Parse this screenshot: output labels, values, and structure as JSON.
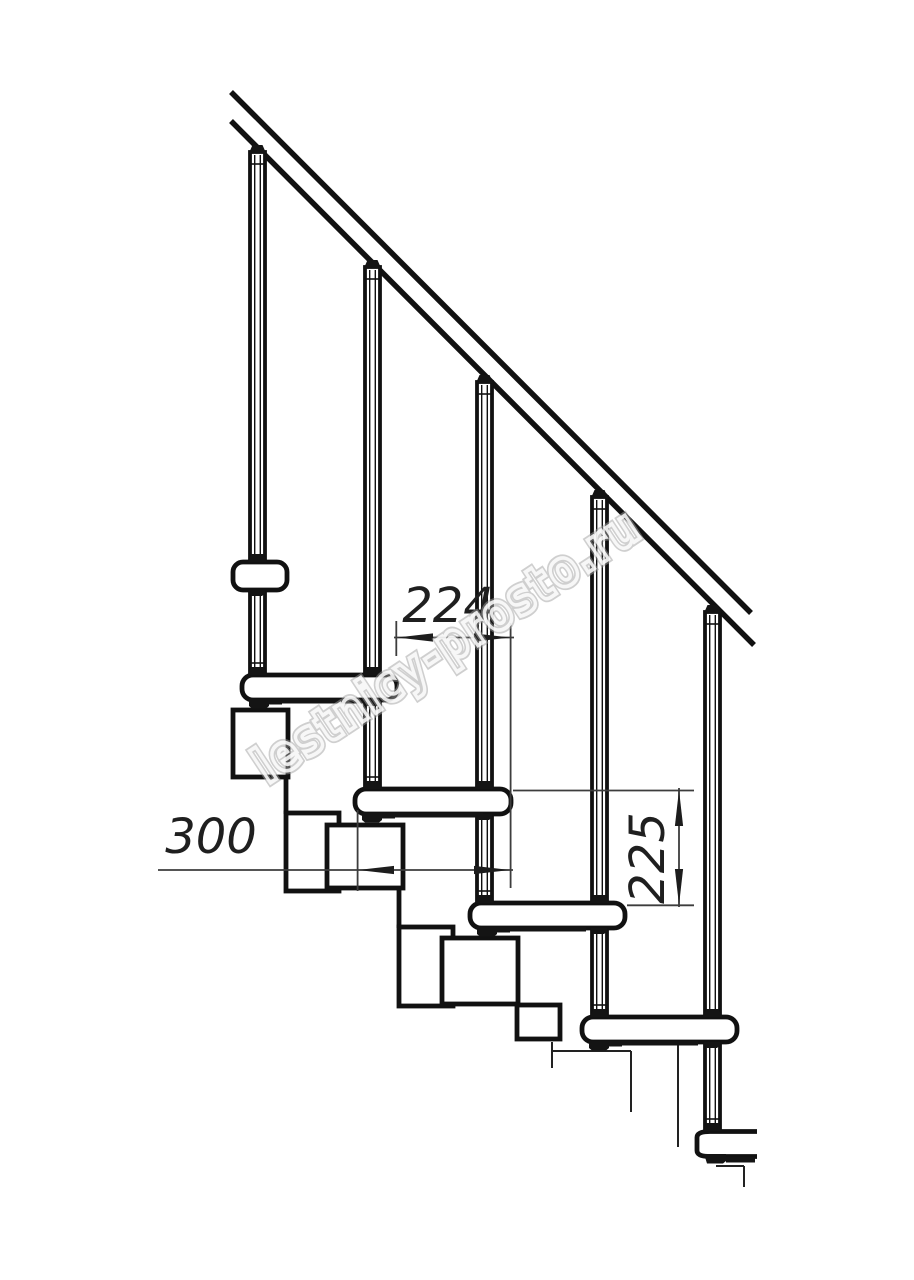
{
  "drawing": {
    "subject": "modular-staircase-side-elevation",
    "colors": {
      "line": "#111111",
      "dimension_line": "#3d3d3d",
      "dimension_text": "#1f1f1f",
      "watermark": "#a0a0a0",
      "background": "#ffffff"
    },
    "dimensions": {
      "step_run": {
        "label": "224"
      },
      "tread_depth": {
        "label": "300"
      },
      "step_rise": {
        "label": "225"
      }
    },
    "watermark": {
      "text": "lestnicy-prosto.ru"
    }
  }
}
